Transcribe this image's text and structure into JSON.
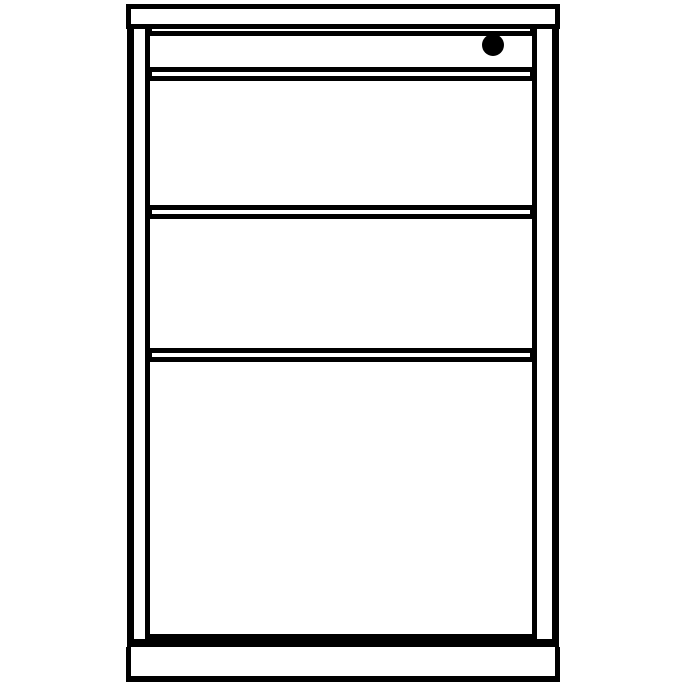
{
  "figure": {
    "kind": "monochrome line drawing",
    "subject": "three-drawer office pedestal cabinet, front elevation",
    "colors": {
      "ink": "#000000",
      "background": "#ffffff"
    },
    "parts": [
      {
        "name": "top-cap",
        "description": "full-width cabinet top bar"
      },
      {
        "name": "lock-strip",
        "description": "thin strip under the top with a round lock cylinder at the right"
      },
      {
        "name": "drawer-1",
        "description": "upper box drawer front"
      },
      {
        "name": "drawer-2",
        "description": "middle box drawer front"
      },
      {
        "name": "drawer-3",
        "description": "tall bottom file drawer front (about double height)"
      },
      {
        "name": "plinth",
        "description": "full-width base plinth"
      }
    ],
    "drawer_count": 3,
    "lock_position": "top-right"
  }
}
